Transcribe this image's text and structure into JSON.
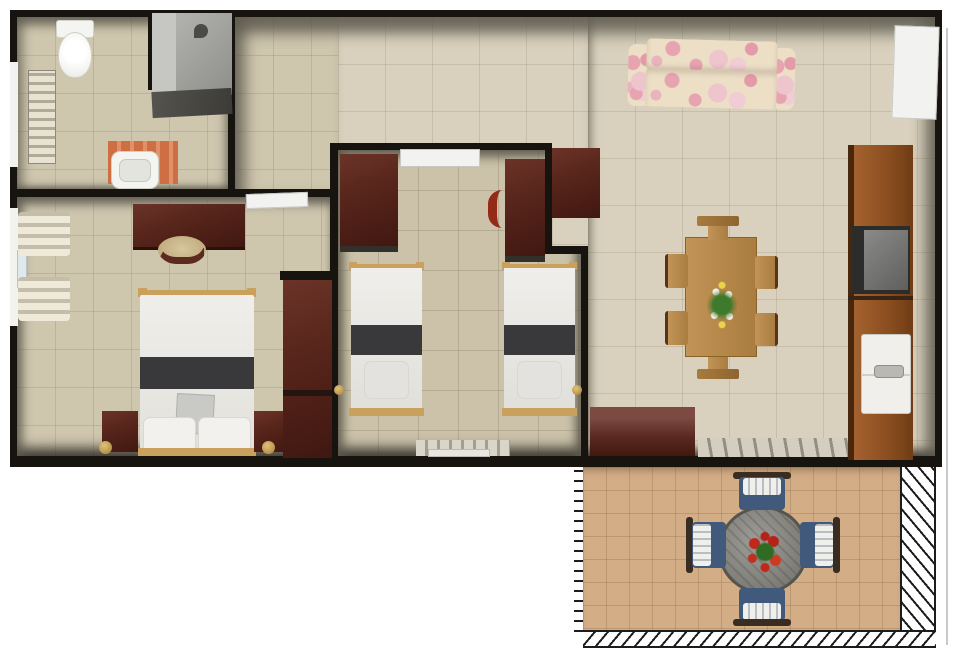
{
  "scene": {
    "type": "floor-plan",
    "view": "top-down 3D rendered apartment plan, no text labels",
    "rooms": [
      {
        "name": "bathroom",
        "position": "top-left",
        "furniture": [
          "toilet",
          "shower-enclosure",
          "shower-head",
          "towel-radiator",
          "vanity-mat",
          "washbasin"
        ]
      },
      {
        "name": "hallway",
        "position": "top-center",
        "furniture": []
      },
      {
        "name": "master-bedroom",
        "position": "left",
        "furniture": [
          "window",
          "roman-curtains",
          "desk",
          "desk-chair",
          "double-bed",
          "bed-stripe-runner",
          "cushion",
          "pillows",
          "nightstand-left",
          "nightstand-right",
          "floor-lamp-left",
          "floor-lamp-right",
          "wardrobe",
          "open-door-leaf"
        ]
      },
      {
        "name": "twin-bedroom",
        "position": "center",
        "furniture": [
          "door-leaf",
          "wardrobe-left",
          "wardrobe-right",
          "red-chair",
          "twin-bed-left",
          "twin-bed-right",
          "wall-knob-left",
          "wall-knob-right",
          "striped-rug",
          "white-mat"
        ],
        "bed_count": 2
      },
      {
        "name": "living-dining-room",
        "position": "right",
        "furniture": [
          "floral-sofa",
          "entry-door-leaf",
          "console-cabinet",
          "dining-table",
          "flower-centerpiece",
          "dining-chair-top",
          "dining-chair-bottom",
          "dining-chair-left-1",
          "dining-chair-left-2",
          "dining-chair-right-1",
          "dining-chair-right-2",
          "sideboard",
          "doormat",
          "kitchen-unit",
          "cooktop",
          "kitchen-sink"
        ],
        "dining_chair_count": 6
      },
      {
        "name": "patio",
        "position": "bottom-right",
        "furniture": [
          "round-table",
          "red-flower-centerpiece",
          "patio-chair-top",
          "patio-chair-bottom",
          "patio-chair-left",
          "patio-chair-right",
          "hatched-border-left",
          "hatched-border-right",
          "hatched-border-bottom"
        ],
        "chair_count": 4
      }
    ],
    "palette": {
      "background": "#ffffff",
      "wall": "#17130e",
      "wall_face": "#8a877a",
      "floor_indoor": "#cfc6ae",
      "floor_living": "#d9d1bd",
      "floor_twin": "#cbc2a9",
      "floor_patio": "#d2ad86",
      "dark_wood": "#56241a",
      "kitchen_wood": "#8a4d1f",
      "oak_wood": "#b98c4f",
      "bed_white": "#ecebe7",
      "bed_stripe": "#39393b",
      "sofa_cream": "#ecdfc6",
      "sofa_pink": "#e8a3b0",
      "patio_blue": "#41597a",
      "accent_red": "#942a18",
      "shower_gray": "#9c9c9a",
      "gold": "#c19b4f"
    }
  }
}
